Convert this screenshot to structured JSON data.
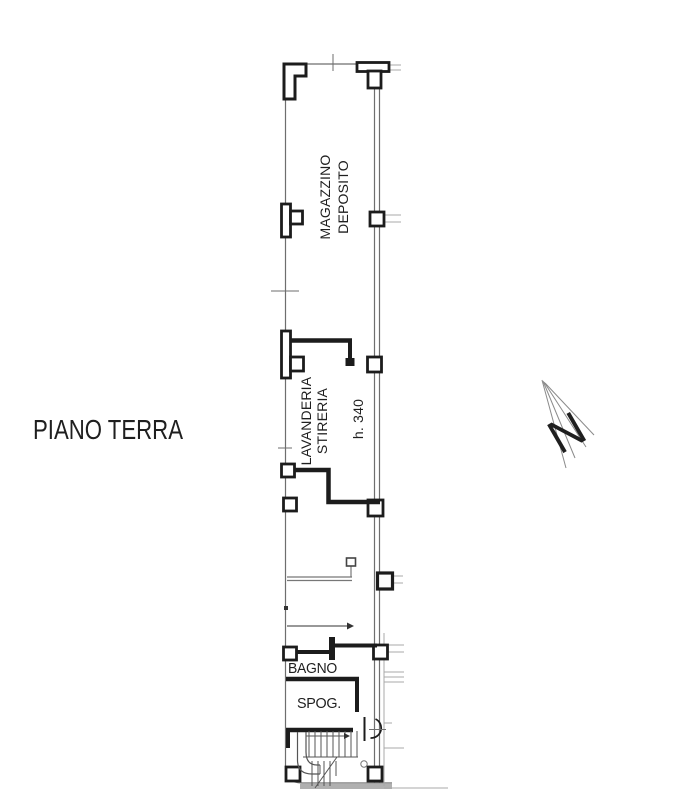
{
  "title": "PIANO TERRA",
  "plan": {
    "rooms": {
      "magazzino": {
        "label_line1": "MAGAZZINO",
        "label_line2": "DEPOSITO"
      },
      "lavanderia": {
        "label_line1": "LAVANDERIA",
        "label_line2": "STIRERIA",
        "height_note": "h. 340"
      },
      "bagno": {
        "label": "BAGNO"
      },
      "spogliatoio": {
        "label": "SPOG."
      }
    }
  },
  "north_arrow": {
    "label": "N"
  },
  "colors": {
    "wall_ink": "#1c1c1c",
    "line_gray": "#6e6e6e",
    "light_gray": "#a8a8a8",
    "background": "#ffffff"
  }
}
